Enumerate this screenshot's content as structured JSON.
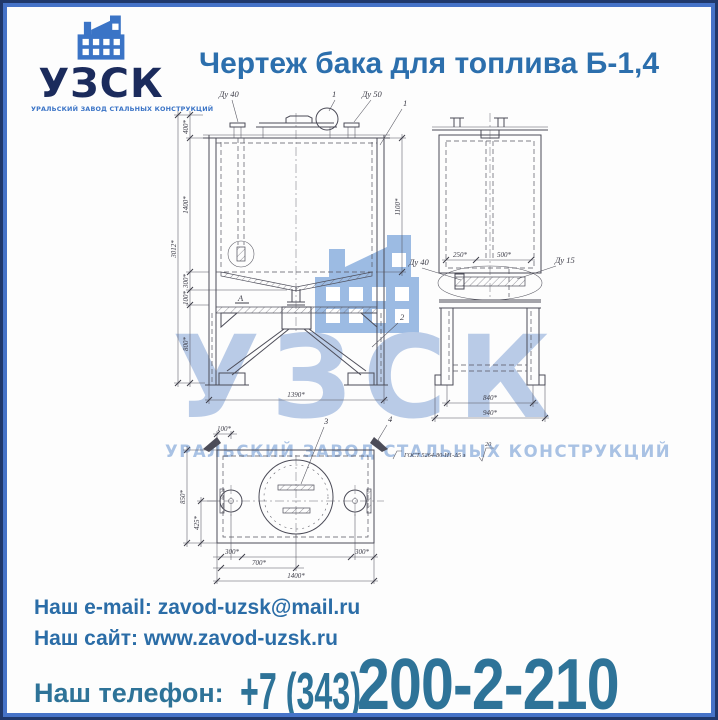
{
  "page": {
    "title": "Чертеж бака для топлива Б-1,4"
  },
  "logo": {
    "name": "УЗСК",
    "subtitle": "УРАЛЬСКИЙ ЗАВОД СТАЛЬНЫХ КОНСТРУКЦИЙ"
  },
  "watermark": {
    "name": "УЗСК",
    "subtitle": "УРАЛЬСКИЙ ЗАВОД СТАЛЬНЫХ КОНСТРУКЦИЙ"
  },
  "drawing": {
    "front": {
      "dy40": "Ду 40",
      "c1": "1",
      "dy50": "Ду 50",
      "c1b": "1",
      "c2": "2",
      "view_a": "А",
      "d400": "400*",
      "d1400": "1400*",
      "d300": "300*",
      "d100": "100*",
      "d800": "800*",
      "d_total": "3012*",
      "d1100": "1100*",
      "d1390": "1390*"
    },
    "side": {
      "d250": "250*",
      "d500": "500*",
      "dy40": "Ду 40",
      "dy15": "Ду 15",
      "d840": "840*",
      "d940": "940*"
    },
    "plan": {
      "c3": "3",
      "c4": "4",
      "weld": "ГОСТ 5264-80-Н1-Δ5 э",
      "weld_val": "20",
      "d100": "100*",
      "d850": "850*",
      "d425": "425*",
      "d300l": "300*",
      "d700": "700*",
      "d300r": "300*",
      "d1400": "1400*"
    }
  },
  "footer": {
    "email_label": "Наш e-mail:",
    "email_value": "zavod-uzsk@mail.ru",
    "site_label": "Наш сайт:",
    "site_value": "www.zavod-uzsk.ru",
    "phone_label": "Наш телефон:",
    "phone_prefix": "+7 (343)",
    "phone_number": "200-2-210"
  },
  "colors": {
    "title_blue": "#2c6fad",
    "footer_blue": "#2b6da7",
    "phone_teal": "#2e7398",
    "logo_navy": "#1b2b5c",
    "logo_blue": "#3b74c6",
    "border_navy": "#20386b",
    "border_blue": "#4673c8",
    "watermark_blue": "#b9cbe7"
  }
}
